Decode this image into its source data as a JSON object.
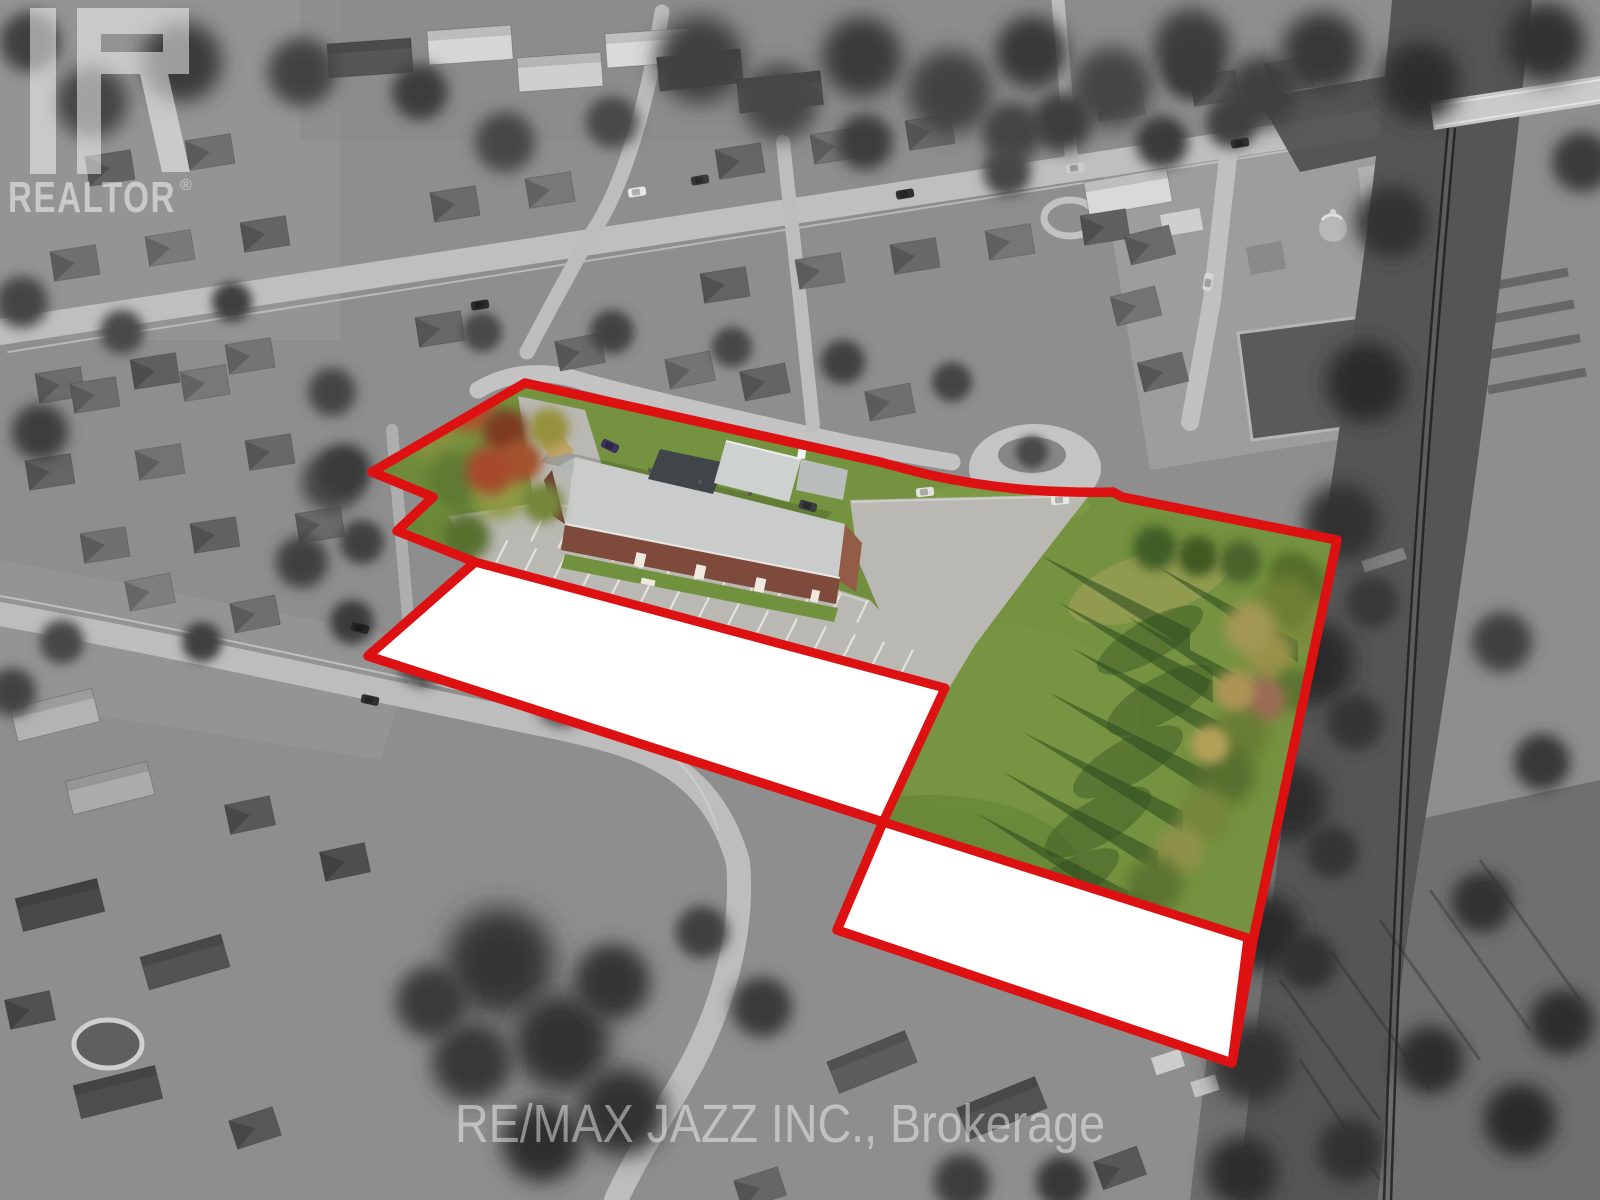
{
  "image": {
    "type": "aerial photograph (real estate listing)",
    "description": "Oblique black-and-white aerial view of a suburban neighbourhood; a church property and adjoining vacant field are shown in colour inside a thick red boundary, with two adjoining parcels masked out in solid white.",
    "highlight_color": "#dd1111",
    "masked_parcel_fill": "#ffffff"
  },
  "watermarks": {
    "realtor_logo_text": "REALTOR",
    "registered_mark": "®",
    "brokerage": "RE/MAX JAZZ INC., Brokerage"
  },
  "palette": {
    "grayscale_base": "#8e8e8e",
    "road_gray": "#c2c2c2",
    "field_green": "#74923f",
    "dark_tree_green": "#45622c",
    "autumn_orange": "#b0512f",
    "church_roof_gray": "#c9ccca",
    "church_brick": "#7d4a3b",
    "steeple_white": "#f4f4f1"
  },
  "scene": {
    "highlighted_features": [
      "church building with white steeple",
      "striped parking lot",
      "large green field",
      "tree row with long shadows along east side",
      "cul-de-sac at the north boundary"
    ],
    "masked_parcels_count": 2
  }
}
